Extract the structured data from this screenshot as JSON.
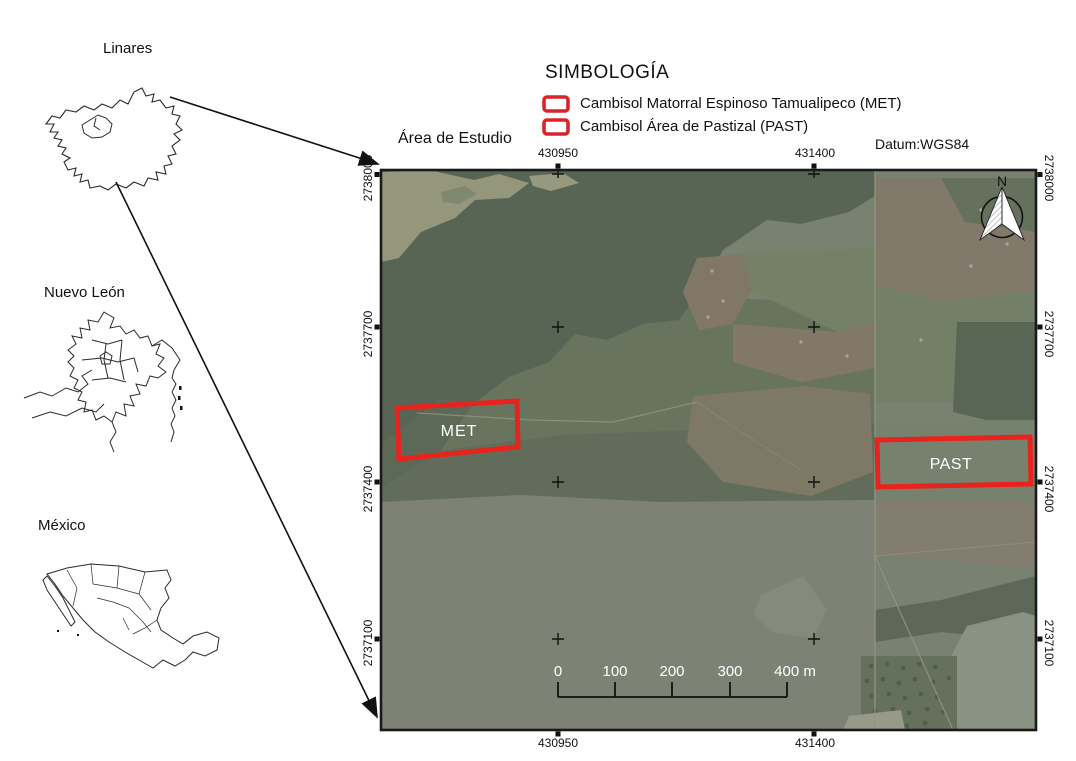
{
  "insets": {
    "linares": {
      "label": "Linares"
    },
    "nuevo_leon": {
      "label": "Nuevo León"
    },
    "mexico": {
      "label": "México"
    }
  },
  "legend": {
    "title": "SIMBOLOGÍA",
    "items": [
      {
        "label": "Cambisol Matorral Espinoso Tamualipeco (MET)",
        "swatch_color": "#d9252a"
      },
      {
        "label": "Cambisol Área de Pastizal (PAST)",
        "swatch_color": "#d9252a"
      }
    ],
    "datum_label": "Datum:WGS84"
  },
  "map": {
    "title": "Área de Estudio",
    "north_arrow_label": "N",
    "easting_ticks": [
      "430950",
      "431400"
    ],
    "northing_ticks": [
      "2738000",
      "2737700",
      "2737400",
      "2737100"
    ],
    "zones": [
      {
        "label": "MET",
        "outline_color": "#e8231d"
      },
      {
        "label": "PAST",
        "outline_color": "#e8231d"
      }
    ],
    "scalebar": {
      "labels": [
        "0",
        "100",
        "200",
        "300",
        "400 m"
      ]
    }
  }
}
